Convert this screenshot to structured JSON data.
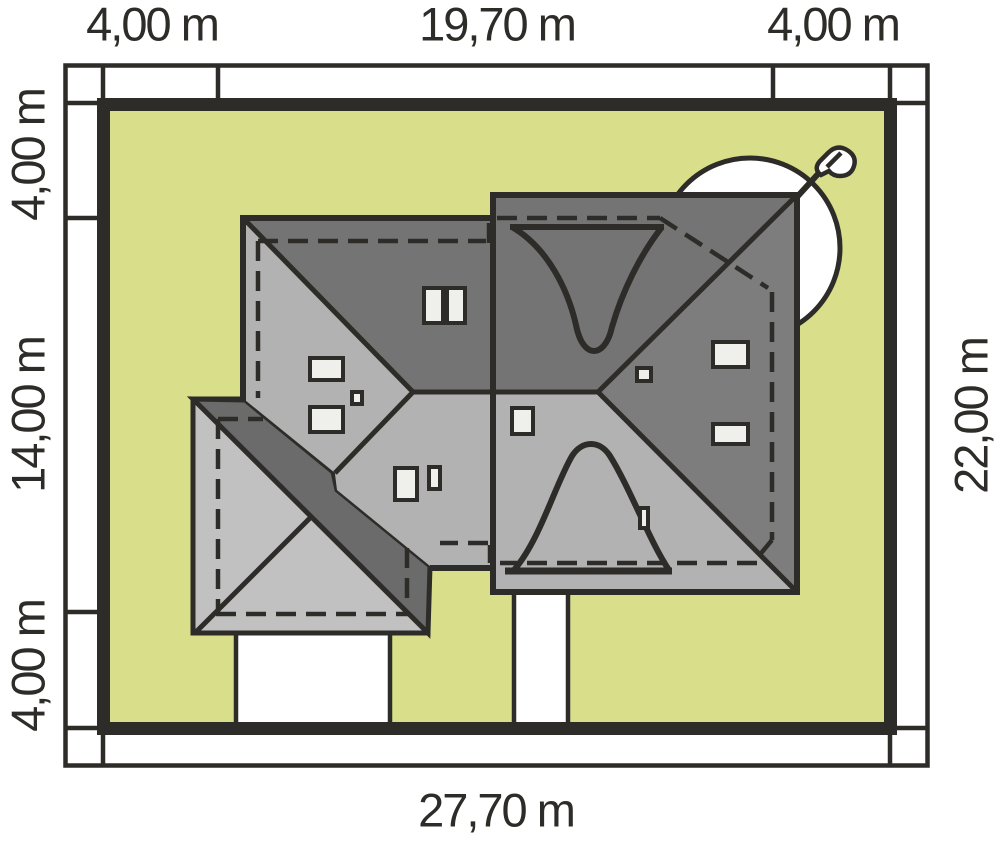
{
  "plan_title": "house-site-plan",
  "dimensions": {
    "top": [
      "4,00 m",
      "19,70 m",
      "4,00 m"
    ],
    "left": [
      "4,00 m",
      "14,00 m",
      "4,00 m"
    ],
    "right": [
      "22,00 m"
    ],
    "bottom": [
      "27,70 m"
    ]
  },
  "colors": {
    "plot_green": "#d9de8b",
    "roof_dark": "#747474",
    "roof_dark2": "#7d7d7d",
    "roof_light": "#b2b2b2",
    "garage_light": "#c1c1c1",
    "band_gray": "#6b6b6b",
    "skylight": "#efefec",
    "outline_dark": "#2d2c28",
    "paving_white": "#ffffff"
  },
  "icons": [
    {
      "name": "tree-canopy-icon"
    },
    {
      "name": "chimney-antenna-icon"
    }
  ]
}
